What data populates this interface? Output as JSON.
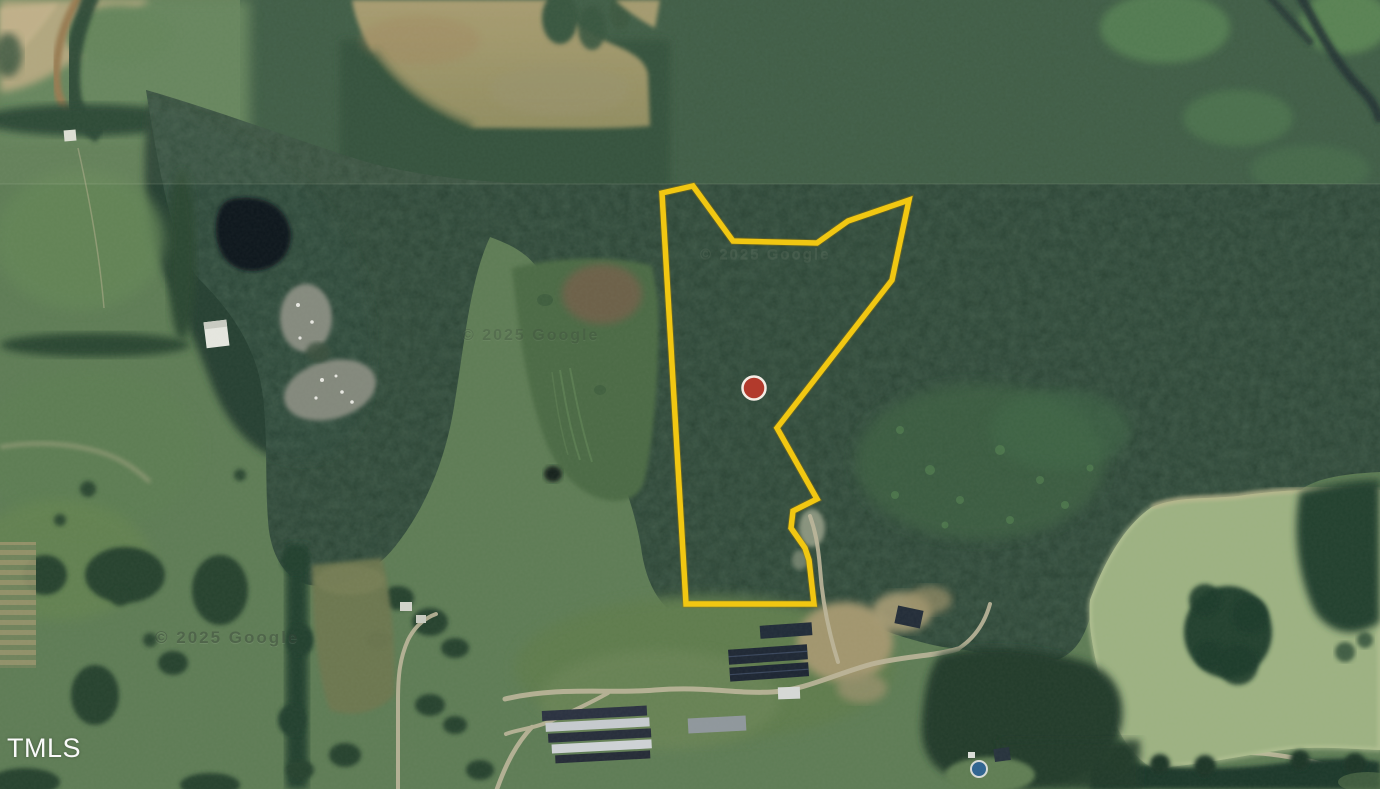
{
  "map": {
    "provider_attribution": "TMLS",
    "watermarks": {
      "w1": "© 2025 Google",
      "w2": "© 2025 Google",
      "w3": "© 2025 Google"
    },
    "parcel": {
      "boundary_points": "662,193 693,186 733,241 817,243 848,221 909,200 892,280 777,428 817,499 793,511 791,528 805,548 809,560 814,604 686,604",
      "boundary_color": "#F1C712",
      "boundary_underglow": "#A57F00",
      "marker": {
        "x": "754",
        "y": "388",
        "r": "11.5",
        "fill": "#B23A2C",
        "ring": "#F5EDE5"
      }
    }
  }
}
